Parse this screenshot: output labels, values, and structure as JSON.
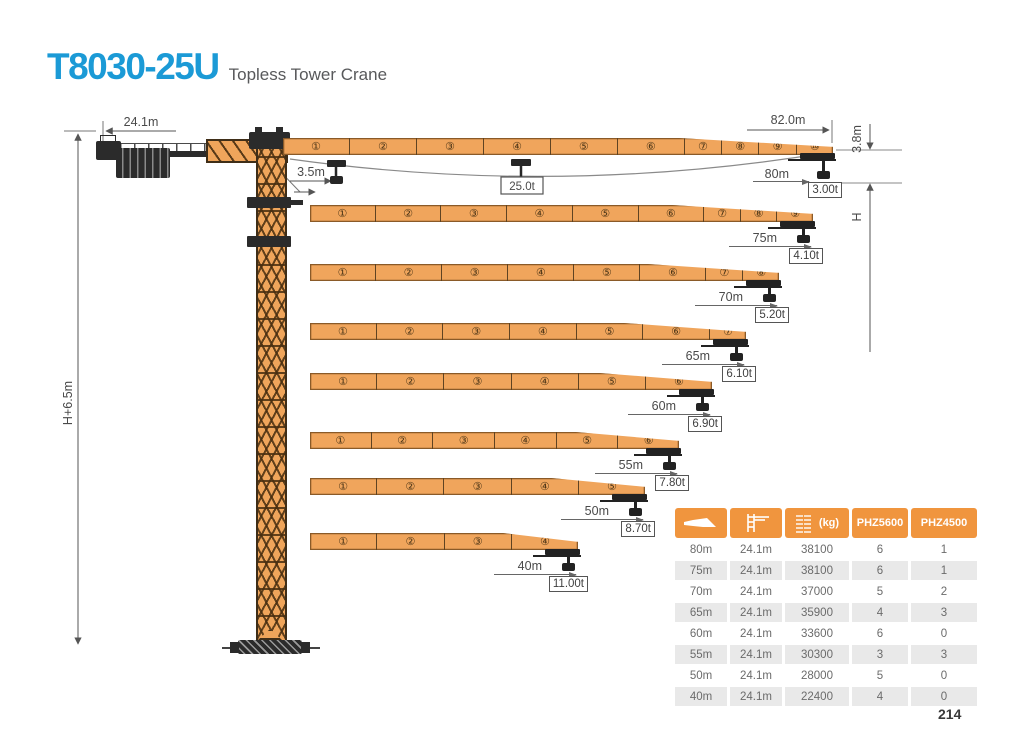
{
  "header": {
    "title": "T8030-25U",
    "subtitle": "Topless Tower Crane"
  },
  "page_number": "214",
  "diagram": {
    "labels": {
      "counter_jib_length": "24.1m",
      "jib_length": "82.0m",
      "min_radius": "3.5m",
      "max_capacity": "25.0t",
      "tip_offset": "3.8m",
      "hook_height": "H",
      "total_height": "H+6.5m"
    },
    "jibs": [
      {
        "radius": "80m",
        "capacity": "3.00t",
        "segments": [
          "①",
          "②",
          "③",
          "④",
          "⑤",
          "⑥",
          "⑦",
          "⑧",
          "⑨",
          "⑩"
        ]
      },
      {
        "radius": "75m",
        "capacity": "4.10t",
        "segments": [
          "①",
          "②",
          "③",
          "④",
          "⑤",
          "⑥",
          "⑦",
          "⑧",
          "⑨"
        ]
      },
      {
        "radius": "70m",
        "capacity": "5.20t",
        "segments": [
          "①",
          "②",
          "③",
          "④",
          "⑤",
          "⑥",
          "⑦",
          "⑧"
        ]
      },
      {
        "radius": "65m",
        "capacity": "6.10t",
        "segments": [
          "①",
          "②",
          "③",
          "④",
          "⑤",
          "⑥",
          "⑦"
        ]
      },
      {
        "radius": "60m",
        "capacity": "6.90t",
        "segments": [
          "①",
          "②",
          "③",
          "④",
          "⑤",
          "⑥"
        ]
      },
      {
        "radius": "55m",
        "capacity": "7.80t",
        "segments": [
          "①",
          "②",
          "③",
          "④",
          "⑤",
          "⑥"
        ]
      },
      {
        "radius": "50m",
        "capacity": "8.70t",
        "segments": [
          "①",
          "②",
          "③",
          "④",
          "⑤"
        ]
      },
      {
        "radius": "40m",
        "capacity": "11.00t",
        "segments": [
          "①",
          "②",
          "③",
          "④"
        ]
      }
    ]
  },
  "table": {
    "headers": [
      {
        "icon": "jib-length-icon",
        "label": ""
      },
      {
        "icon": "counter-jib-icon",
        "label": ""
      },
      {
        "icon": "ballast-icon",
        "label": "(kg)"
      },
      {
        "label": "PHZ5600"
      },
      {
        "label": "PHZ4500"
      }
    ],
    "rows": [
      [
        "80m",
        "24.1m",
        "38100",
        "6",
        "1"
      ],
      [
        "75m",
        "24.1m",
        "38100",
        "6",
        "1"
      ],
      [
        "70m",
        "24.1m",
        "37000",
        "5",
        "2"
      ],
      [
        "65m",
        "24.1m",
        "35900",
        "4",
        "3"
      ],
      [
        "60m",
        "24.1m",
        "33600",
        "6",
        "0"
      ],
      [
        "55m",
        "24.1m",
        "30300",
        "3",
        "3"
      ],
      [
        "50m",
        "24.1m",
        "28000",
        "5",
        "0"
      ],
      [
        "40m",
        "24.1m",
        "22400",
        "4",
        "0"
      ]
    ]
  },
  "colors": {
    "accent_blue": "#1b9ad6",
    "crane_orange": "#f0a55c",
    "table_header_orange": "#f0953e"
  }
}
